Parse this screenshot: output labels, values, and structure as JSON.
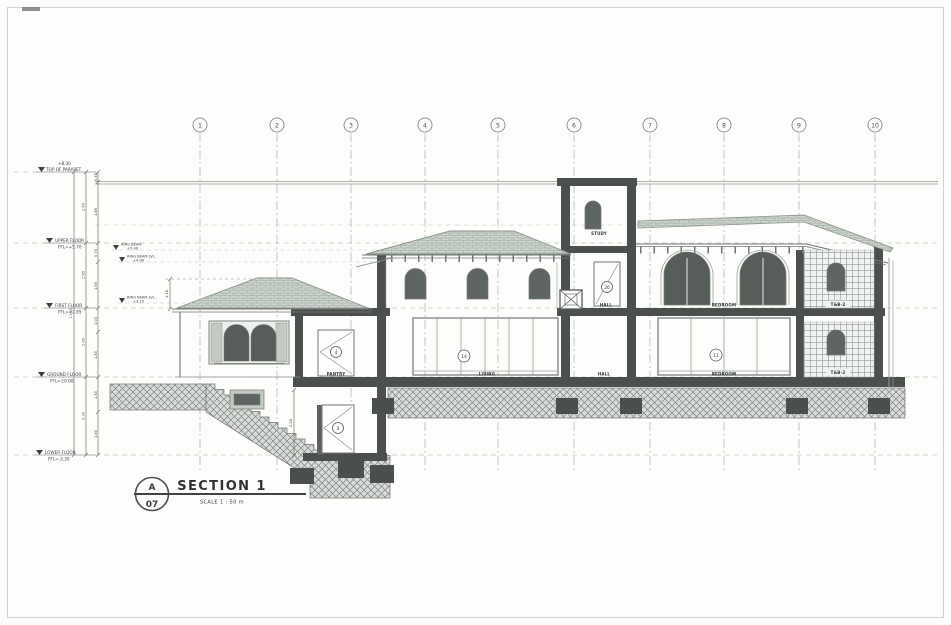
{
  "grid_bubbles": [
    "1",
    "2",
    "3",
    "4",
    "5",
    "6",
    "7",
    "8",
    "9",
    "10"
  ],
  "levels": [
    {
      "name": "TOP OF PARAPET",
      "elev": "+8.30"
    },
    {
      "name": "UPPER FLOOR",
      "elev": "FFL=+5.70"
    },
    {
      "name": "FIRST FLOOR",
      "elev": "FFL=+2.85"
    },
    {
      "name": "GROUND FLOOR",
      "elev": "FFL=±0.00"
    },
    {
      "name": "LOWER FLOOR",
      "elev": "FFL=-3.30"
    }
  ],
  "ring_beams": [
    {
      "name": "RING BEAM",
      "elev": "+5.40"
    },
    {
      "name": "RING BEAM LVL.",
      "elev": "+4.90"
    },
    {
      "name": "RING BEAM LVL.",
      "elev": "+3.15"
    }
  ],
  "rooms": {
    "study": "STUDY",
    "hall_upper": "HALL",
    "hall_ground": "HALL",
    "pantry": "PANTRY",
    "living": "LIVING",
    "bedroom_upper": "BEDROOM",
    "bedroom_ground": "BEDROOM",
    "tnb_upper": "T&B-2",
    "tnb_ground": "T&B-2"
  },
  "tags": {
    "pantry_door": "4",
    "lower_door": "3",
    "hall_door": "26",
    "living_glazing": "14",
    "bedroom_glazing": "11"
  },
  "dimensions": {
    "overall": "11.60",
    "floors": [
      "2.60",
      "2.85",
      "2.85",
      "3.30"
    ],
    "sub": [
      "0.45",
      "1.85",
      "0.75",
      "1.85",
      "1.00",
      "1.80",
      "1.50",
      "1.80"
    ],
    "roof_height": "1.18",
    "lower_room_height": "2.26"
  },
  "title_block": {
    "detail_letter": "A",
    "sheet_number": "07",
    "title": "SECTION 1",
    "scale_label": "SCALE   1 : 50 m"
  }
}
